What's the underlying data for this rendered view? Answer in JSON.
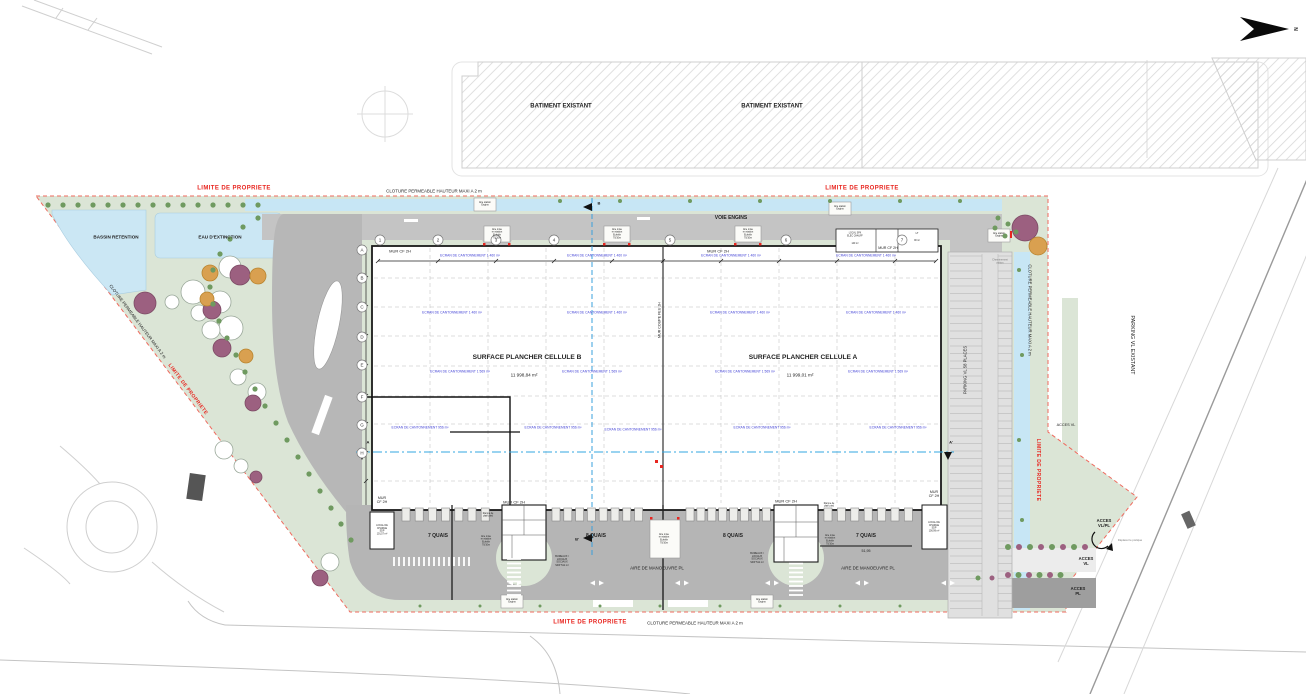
{
  "colors": {
    "green": "#dbe5d6",
    "road": "#c4c4c4",
    "lot": "#b7b7b7",
    "apron": "#b5b5b5",
    "parking": "#e0e0e0",
    "water": "#cbe7f4",
    "swale": "#c7e6f5",
    "red": "#e8251f",
    "blue": "#4343d6",
    "hatch": "#d8d8d8",
    "dark": "#1a1a1a"
  },
  "labels": {
    "batiment": "BATIMENT EXISTANT",
    "limite": "LIMITE DE PROPRIETE",
    "cloture": "CLOTURE PERMEABLE HAUTEUR MAXI A 2 m",
    "voie_engins": "VOIE ENGINS",
    "bassin": "BASSIN RETENTION",
    "eau": "EAU D'EXTINCTION",
    "cellB_t": "SURFACE PLANCHER CELLULE B",
    "cellB_a": "11 998,84 m²",
    "cellA_t": "SURFACE PLANCHER CELLULE A",
    "cellA_a": "11 999,01 m²",
    "m1": "MUR CF 2H",
    "m2": "MUR\nCF 2H",
    "mur_coupe_feu": "MUR COUPE FEU 2H",
    "e1": "ECRAN DE CANTONNEMENT 1 460 m²",
    "e2": "ECRAN DE CANTONNEMENT 1 569 m²",
    "e3": "ECRAN DE CANTONNEMENT 956 m²",
    "q7": "7 QUAIS",
    "q8": "8 QUAIS",
    "dim5195": "51,95",
    "aire_man": "AIRE DE MANOEUVRE PL",
    "aire_ech": "Aire mise\nen station\nEchelle\n70/10m",
    "rampe": "Rampe de\nplain pied",
    "aire_eng": "Aire station\nEngins",
    "pvl58": "PARKING VL 58 PLACES",
    "pvl_exist": "PARKING VL EXISTANT",
    "acces_vl": "ACCES VL",
    "acces_vlpl": "ACCES\nVL/PL",
    "acces_vl2": "ACCES\nVL",
    "acces_pl": "ACCES\nPL",
    "chemin": "Cheminement\npiéton",
    "deplacer": "Déplacer le portique",
    "local_spk": "LOCAL SPK\nELEC CHAUFF",
    "local_spk_a": "140 m²",
    "lt": "LT",
    "lt_a": "90 m²",
    "lcb": "LOCAL DE\nCHARGE\nSDP\n101,57 m²",
    "lca": "LOCAL DE\nCHARGE\nSDP\n100,99 m²",
    "bureaux": "BUREAUX /\nLOCAUX\nSOCIAUX\nSDP 511 m²",
    "north": "N",
    "sA": "A",
    "sA2": "A'",
    "sB": "B",
    "sB2": "B'"
  },
  "grid": {
    "left": [
      "A",
      "B",
      "C",
      "D",
      "E",
      "F",
      "G",
      "H"
    ],
    "top": [
      "1",
      "2",
      "3",
      "4",
      "5",
      "6",
      "7"
    ]
  }
}
